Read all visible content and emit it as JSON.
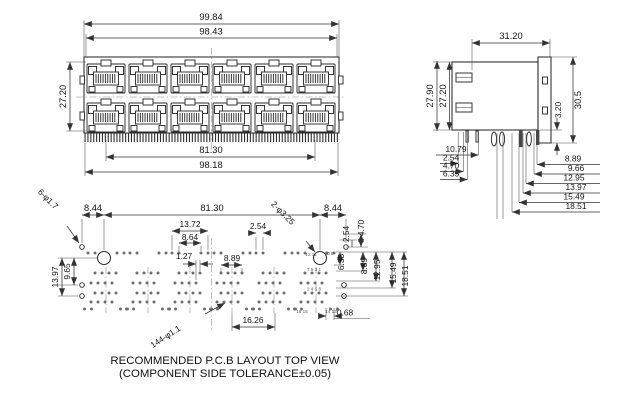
{
  "drawing": {
    "front_view": {
      "dim_total_width": "99.84",
      "dim_body_width": "98.43",
      "dim_height": "27.20",
      "dim_pin_span": "81.30",
      "dim_overall_bottom": "98.18"
    },
    "side_view": {
      "dim_depth": "31.20",
      "dim_height_outer": "27.90",
      "dim_height_inner": "27.20",
      "dim_flange_step": "3.20",
      "dim_flange_height": "30.5",
      "left_stack": [
        "10.79",
        "2.54",
        "4.70",
        "6.35"
      ],
      "right_stack": [
        "8.89",
        "9.66",
        "12.95",
        "13.97",
        "15.49",
        "18.51"
      ]
    },
    "pcb_view": {
      "dim_left_offset": "8.44",
      "dim_mount_span": "81.30",
      "dim_right_offset": "8.44",
      "label_corner_holes": "6-φ1.7",
      "label_mount_holes": "2-φ3.25",
      "label_pin_holes": "144-φ1.1",
      "dim_row_outer": "13.72",
      "dim_row_inner": "8.64",
      "dim_pitch": "2.54",
      "dim_stagger": "1.27",
      "dim_group_width": "8.89",
      "dim_left_hole_mid": "9.65",
      "dim_left_hole_low": "13.97",
      "dim_right_top_a": "2.54",
      "dim_right_top_b": "4.70",
      "right_stack": [
        "6.35",
        "8.89",
        "12.95",
        "15.49",
        "18.51"
      ],
      "dim_edge": "0.68",
      "dim_bottom_span": "16.26",
      "pins": {
        "p12_11": "12 11",
        "p10_9": "10 9",
        "odd_row": "7 5 3 1",
        "even_row": "2 4 6 8",
        "p16_15": "16 15",
        "p14_13": "14 13"
      }
    },
    "caption": {
      "line1": "RECOMMENDED P.C.B LAYOUT TOP VIEW",
      "line2": "(COMPONENT SIDE TOLERANCE±0.05)"
    }
  }
}
